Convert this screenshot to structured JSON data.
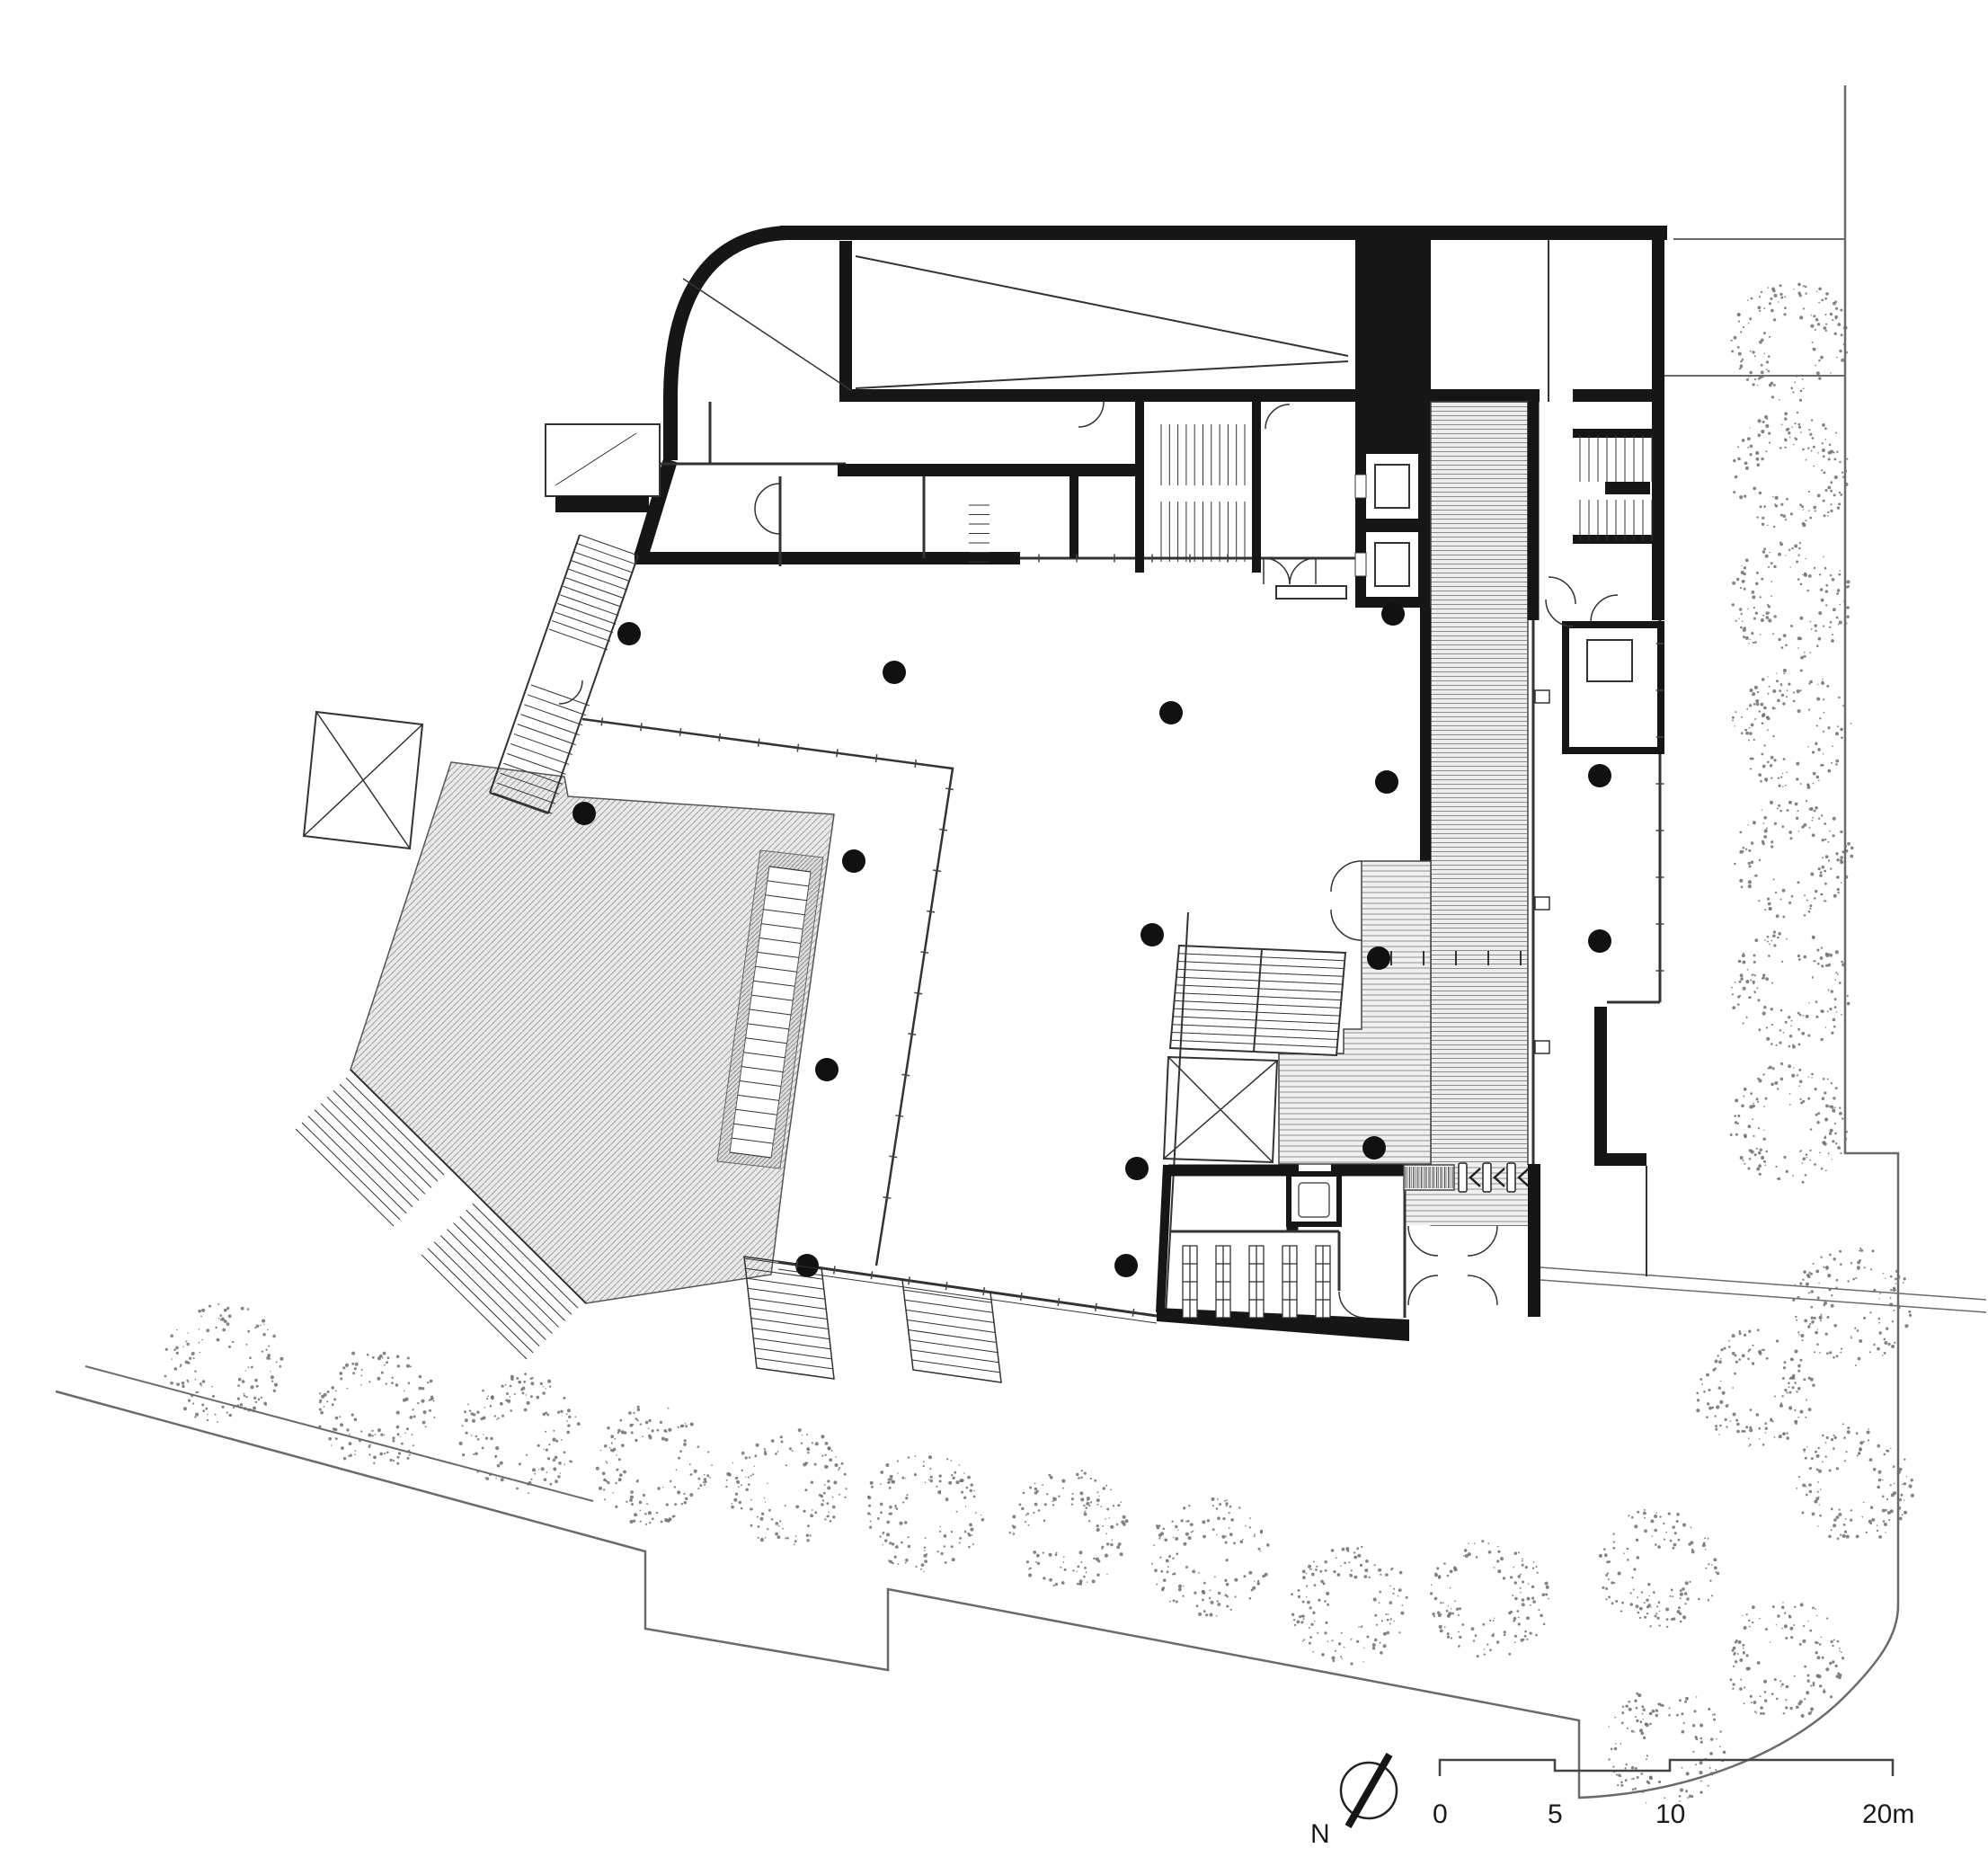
{
  "drawing": {
    "type": "architectural-floor-plan",
    "level": "ground floor"
  },
  "north_arrow": {
    "label": "N"
  },
  "scale_bar": {
    "labels": [
      "0",
      "5",
      "10",
      "20m"
    ],
    "unit": "m",
    "segments_m": [
      0,
      5,
      10,
      20
    ]
  },
  "colors": {
    "paper": "#ffffff",
    "wall": "#161616",
    "line": "#333333",
    "site_line": "#6a6a6a",
    "hatch_bg": "#e9e9e9",
    "hatch_line": "#a0a0a0",
    "deck_bg": "#f0f0f0",
    "deck_line": "#8c8c8c",
    "ramp_bg": "#ededed",
    "ramp_line": "#8c8c8c",
    "tree_dot": "#6f6f6f",
    "column": "#111111"
  },
  "plan": {
    "column_radius": 13,
    "columns": [
      [
        700,
        705
      ],
      [
        995,
        748
      ],
      [
        1303,
        793
      ],
      [
        1550,
        683
      ],
      [
        1543,
        870
      ],
      [
        650,
        905
      ],
      [
        950,
        958
      ],
      [
        920,
        1190
      ],
      [
        898,
        1408
      ],
      [
        1282,
        1040
      ],
      [
        1265,
        1300
      ],
      [
        1253,
        1408
      ],
      [
        1534,
        1066
      ],
      [
        1529,
        1277
      ],
      [
        1780,
        863
      ],
      [
        1780,
        1047
      ]
    ],
    "tree_radius": 66,
    "trees": [
      [
        247,
        1517
      ],
      [
        420,
        1567
      ],
      [
        578,
        1595
      ],
      [
        725,
        1630
      ],
      [
        875,
        1652
      ],
      [
        1028,
        1683
      ],
      [
        1190,
        1702
      ],
      [
        1345,
        1732
      ],
      [
        1502,
        1786
      ],
      [
        1658,
        1777
      ],
      [
        1845,
        1745
      ],
      [
        1952,
        1545
      ],
      [
        2060,
        1452
      ],
      [
        2063,
        1650
      ],
      [
        1985,
        1846
      ],
      [
        1852,
        1944
      ],
      [
        1993,
        380
      ],
      [
        1993,
        525
      ],
      [
        1993,
        668
      ],
      [
        1993,
        812
      ],
      [
        1995,
        955
      ],
      [
        1993,
        1100
      ],
      [
        1990,
        1250
      ]
    ],
    "turnstiles": 3,
    "shelving_units": 5,
    "elevators": 3,
    "entrance_door_pairs": 4
  }
}
